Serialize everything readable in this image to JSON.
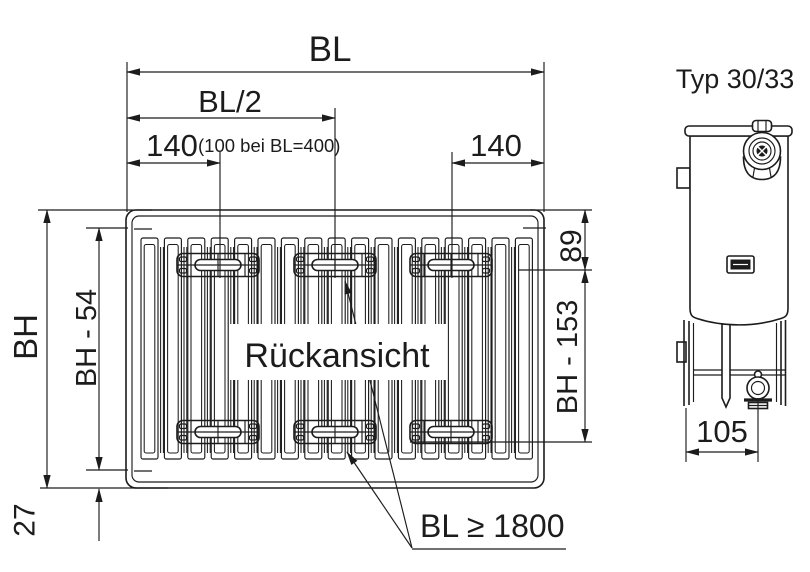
{
  "drawing": {
    "title": "Typ 30/33",
    "rear_view_label": "Rückansicht",
    "installation_note": "BL ≥ 1800",
    "dimensions": {
      "overall_length": "BL",
      "half_length": "BL/2",
      "bracket_offset_left": "140",
      "bracket_offset_left_note": "(100 bei BL=400)",
      "bracket_offset_right": "140",
      "overall_height": "BH",
      "fin_height": "BH - 54",
      "top_to_bracket": "89",
      "bracket_to_bracket": "BH - 153",
      "bottom_clearance": "27",
      "side_depth": "105"
    },
    "colors": {
      "line": "#1c1c1c",
      "background": "#ffffff"
    }
  }
}
